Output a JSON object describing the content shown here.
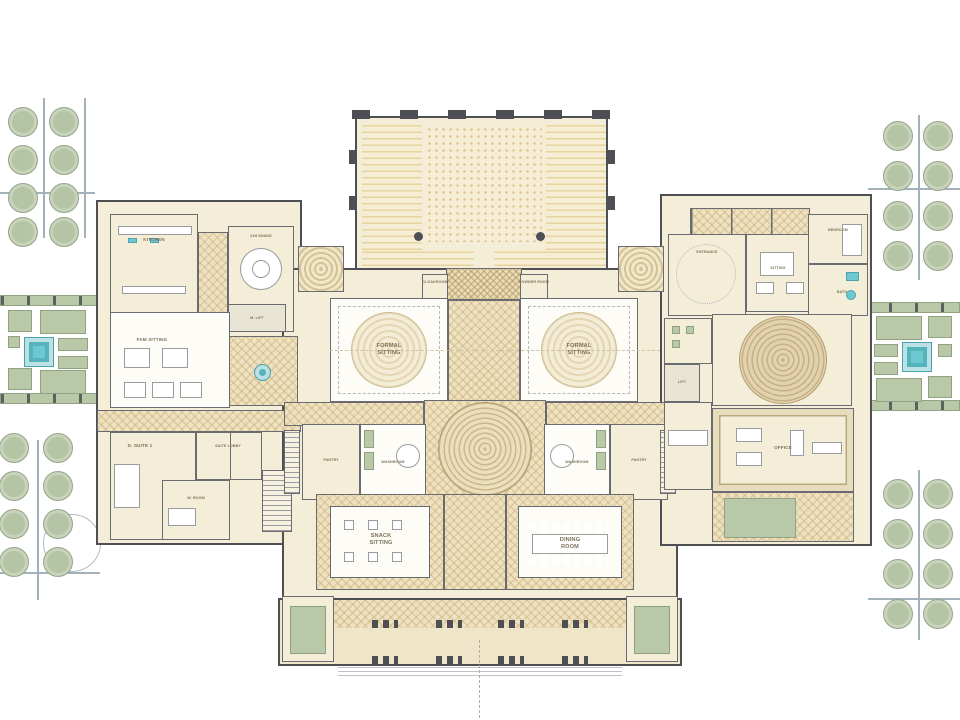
{
  "palette": {
    "wall": "#4e4f55",
    "wall2": "#6a6b71",
    "floor": "#f4edd8",
    "floor2": "#efe5c9",
    "carpet": "#fdfcf7",
    "green": "#b9c9a7",
    "greenLine": "#8fa383",
    "teal": "#6ec8d2",
    "tree": "#b5c4a4",
    "treeLine": "#97a68b",
    "label": "#7c7158",
    "line": "#a3b1ba"
  },
  "rooms": {
    "kitchen": {
      "label": "KITCHEN"
    },
    "dining24": {
      "label": "24H DINING"
    },
    "m_lift": {
      "label": "M. LIFT"
    },
    "fam_sitting": {
      "label": "FAM SITTING"
    },
    "d_suite1": {
      "label": "D. SUITE 1"
    },
    "suite_lobby": {
      "label": "SUITE LOBBY"
    },
    "w_room": {
      "label": "W. ROOM"
    },
    "formal_sitting_left": {
      "label": "FORMAL\nSITTING"
    },
    "formal_sitting_right": {
      "label": "FORMAL\nSITTING"
    },
    "cloakroom": {
      "label": "CLOAKROOM"
    },
    "powder_room": {
      "label": "POWDER ROOM"
    },
    "pantry_left": {
      "label": "PANTRY"
    },
    "pantry_right": {
      "label": "PANTRY"
    },
    "washroom_left": {
      "label": "WASHROOM"
    },
    "washroom_right": {
      "label": "WASHROOM"
    },
    "snack_sitting": {
      "label": "SNACK\nSITTING"
    },
    "dining_room": {
      "label": "DINING\nROOM"
    },
    "entrance": {
      "label": "ENTRANCE"
    },
    "sitting": {
      "label": "SITTING"
    },
    "bedroom": {
      "label": "BEDROOM"
    },
    "bath": {
      "label": "BATH"
    },
    "lift": {
      "label": "LIFT"
    },
    "office": {
      "label": "OFFICE"
    }
  }
}
